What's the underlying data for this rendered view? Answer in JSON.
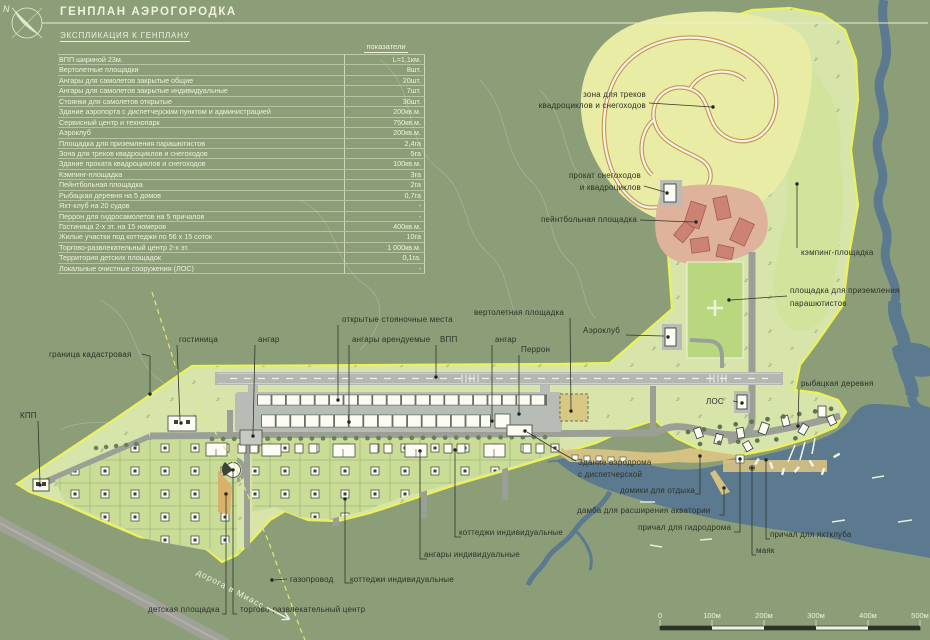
{
  "header": {
    "title": "ГЕНПЛАН АЭРОГОРОДКА",
    "subtitle": "ЭКСПЛИКАЦИЯ К ГЕНПЛАНУ",
    "column_header": "показатели",
    "north_letter": "N"
  },
  "colors": {
    "background": "#8c9e78",
    "site_fill": "#d7e4aa",
    "site_outline": "#edf25b",
    "water": "#5b7a90",
    "track_zone": "#e9eca4",
    "paintball": "#cd8374",
    "helipad": "#d9c784"
  },
  "table": {
    "rows": [
      {
        "name": "ВПП шириной 23м.",
        "value": "L=1,1км."
      },
      {
        "name": "Вертолетные площадки",
        "value": "8шт."
      },
      {
        "name": "Ангары для самолетов закрытые общие",
        "value": "20шт."
      },
      {
        "name": "Ангары для самолетов закрытые индивидуальные",
        "value": "7шт."
      },
      {
        "name": "Стоянки для самолетов открытые",
        "value": "30шт."
      },
      {
        "name": "Здание аэропорта с диспетчерским пунктом и администрацией",
        "value": "200кв.м."
      },
      {
        "name": "Сервисный центр и технопарк",
        "value": "750кв.м."
      },
      {
        "name": "Аэроклуб",
        "value": "200кв.м."
      },
      {
        "name": "Площадка для приземления парашютистов",
        "value": "2,4га"
      },
      {
        "name": "Зона для треков квадроциклов и снегоходов",
        "value": "5га"
      },
      {
        "name": "Здание проката квадроциклов и снегоходов",
        "value": "100кв.м."
      },
      {
        "name": "Кэмпинг-площадка",
        "value": "3га"
      },
      {
        "name": "Пейнтбольная площадка",
        "value": "2га"
      },
      {
        "name": "Рыбацкая деревня на 5 домов",
        "value": "0,7га"
      },
      {
        "name": "Яхт-клуб на 20 судов",
        "value": "-"
      },
      {
        "name": "Перрон для гидросамолетов на 5 причалов",
        "value": "-"
      },
      {
        "name": "Гостиница  2-х эт.  на 15 номеров",
        "value": "400кв.м."
      },
      {
        "name": "Жилые участки под коттеджи по 56 х 15 соток",
        "value": "10га"
      },
      {
        "name": "Торгово-развлекательный центр 2-х эт.",
        "value": "1 000кв.м."
      },
      {
        "name": "Территория детских площадок",
        "value": "0,1га."
      },
      {
        "name": "Локальные очистные сооружения (ЛОС)",
        "value": "-"
      }
    ]
  },
  "map_labels": {
    "zone_tracks_l1": "зона для треков",
    "zone_tracks_l2": "квадроциклов и снегоходов",
    "rent_l1": "прокат снегоходов",
    "rent_l2": "и квадроциклов",
    "paintball": "пейнтбольная площадка",
    "camping": "кэмпинг-площадка",
    "parachute_l1": "площадка для приземления",
    "parachute_l2": "парашютистов",
    "fishing": "рыбацкая деревня",
    "aeroclub": "Аэроклуб",
    "heliport": "вертолетная площадка",
    "open_parking": "открытые стояночные места",
    "hangars_rented": "ангары арендуемые",
    "vpp": "ВПП",
    "hangar_right": "ангар",
    "hangar_left": "ангар",
    "hotel": "гостиница",
    "perron": "Перрон",
    "cadastral": "граница кадастровая",
    "kpp": "КПП",
    "airport_l1": "Здание аэродрома",
    "airport_l2": "с диспетчерской",
    "los": "ЛОС",
    "cottages_right": "коттеджи индивидуальные",
    "hangars_ind": "ангары индивидуальные",
    "gas": "газопровод",
    "cottages_mid": "коттеджи индивидуальные",
    "playground": "детская площадка",
    "mall": "торгово-развлекательный центр",
    "domiki": "домики для отдыха",
    "damba": "дамба для расширения акватории",
    "pier_hydro": "причал для гидродрома",
    "pier_yacht": "причал для яхтклуба",
    "mayak": "маяк",
    "road": "дорога в Миасс"
  },
  "scalebar": {
    "v0": "0",
    "v100": "100м",
    "v200": "200м",
    "v300": "300м",
    "v400": "400м",
    "v500": "500м"
  }
}
